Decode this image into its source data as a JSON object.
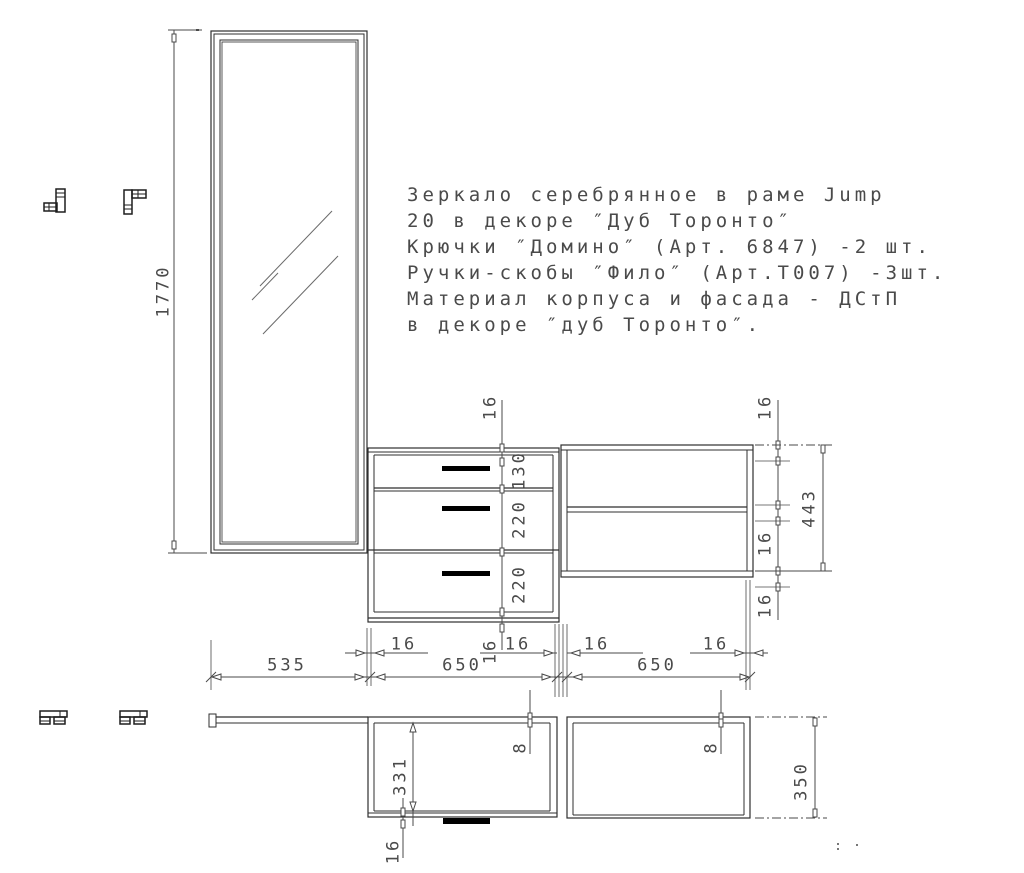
{
  "colors": {
    "background": "#ffffff",
    "structure_line": "#2f2f2f",
    "dimension_line": "#4a4a4a",
    "text": "#4a4a4a",
    "drawer_handle": "#000000"
  },
  "description": {
    "lines": [
      "Зеркало серебрянное в раме Jump",
      "20 в декоре ″Дуб Торонто″",
      "Крючки ″Домино″ (Арт. 6847) -2 шт.",
      "Ручки-скобы ″Фило″ (Арт.Т007) -3шт.",
      "Материал корпуса и фасада - ДСтП",
      "в декоре ″дуб Торонто″."
    ]
  },
  "dimensions": {
    "front": {
      "mirror_height": "1770",
      "drawer_top_panel": "16",
      "drawer_1": "130",
      "drawer_2": "220",
      "drawer_3": "220",
      "drawer_bottom_panel": "16",
      "shelf_top_panel": "16",
      "shelf_middle_panel": "16",
      "shelf_bottom_panel": "16",
      "shelf_unit_height": "443"
    },
    "widths": {
      "mirror": "535",
      "drawer_unit": "650",
      "shelf_unit": "650",
      "panel_thickness": "16"
    },
    "plan": {
      "drawer_inner_depth": "331",
      "front_panel": "16",
      "back_gap_left": "8",
      "back_gap_right": "8",
      "unit_depth": "350"
    }
  }
}
